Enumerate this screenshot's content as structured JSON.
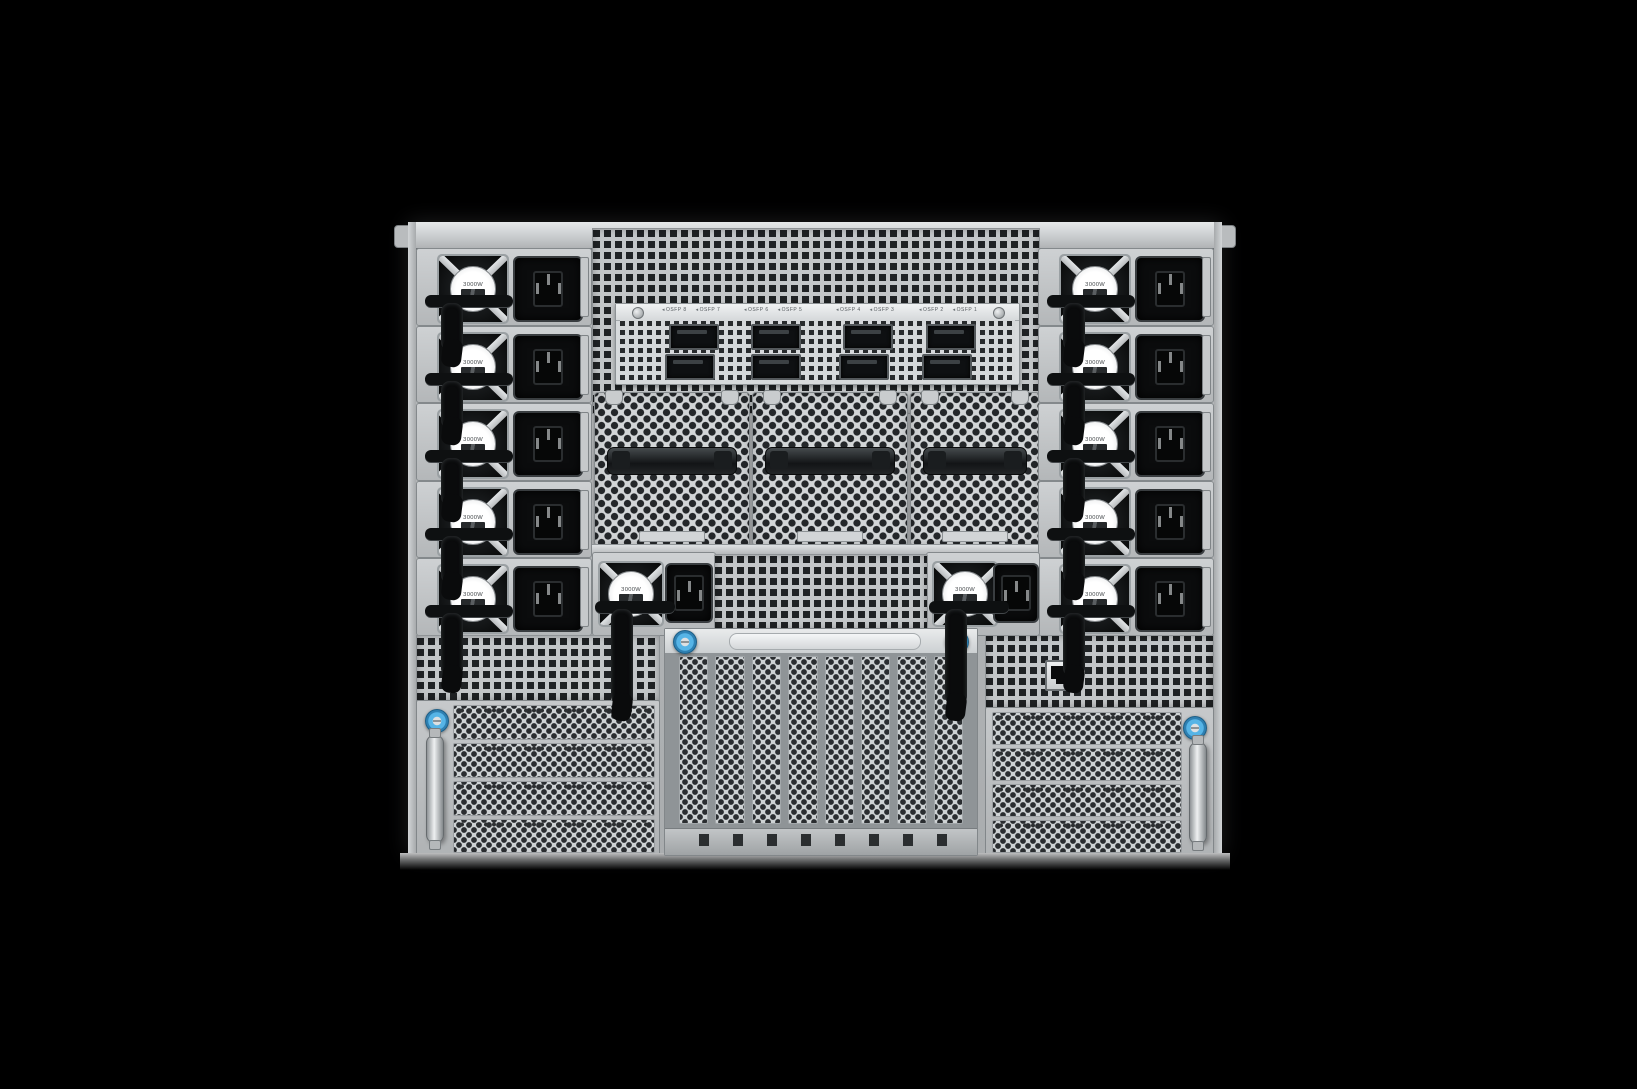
{
  "psu": {
    "wattage_label": "3000W",
    "count": 12
  },
  "osfp": {
    "marker": "◂",
    "labels": [
      "OSFP 8",
      "OSFP 7",
      "OSFP 6",
      "OSFP 5",
      "OSFP 4",
      "OSFP 3",
      "OSFP 2",
      "OSFP 1"
    ]
  },
  "ports": {
    "osfp_cage_count": 8,
    "power_inlet_type": "C19",
    "management_port": "RJ45"
  },
  "colors": {
    "background": "#000000",
    "chassis_silver": "#c3c6c8",
    "vent_hole_dark": "#232628",
    "thumbscrew_blue": "#56b4e6",
    "inlet_black": "#0b0c0d"
  },
  "icons": {
    "fan": "psu-fan-icon",
    "strap": "velcro-strap-icon",
    "thumbscrew": "blue-thumbscrew-icon",
    "handle": "bay-handle-icon",
    "rj45": "rj45-port-icon"
  }
}
